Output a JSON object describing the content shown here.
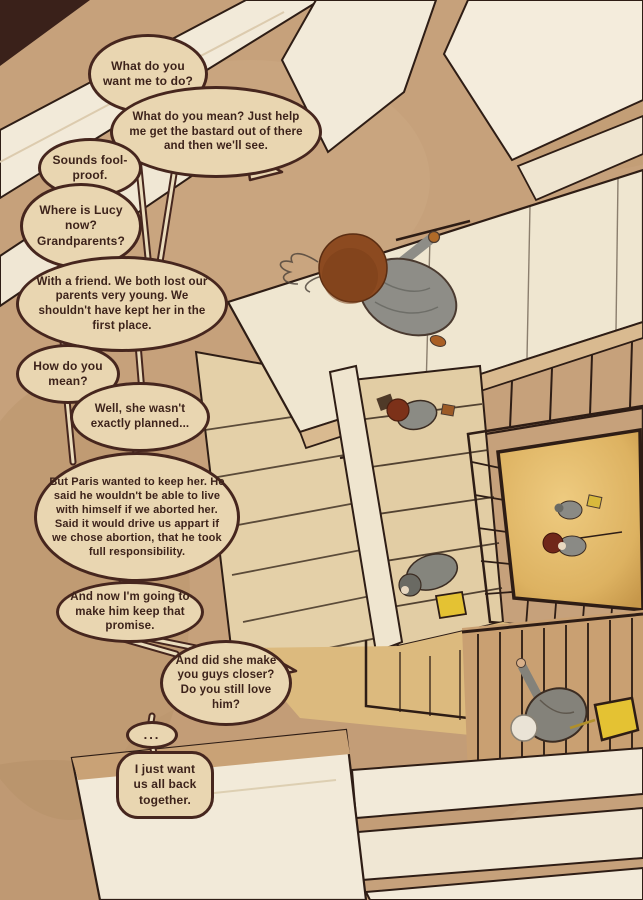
{
  "palette": {
    "paper_tan": "#c6a17b",
    "bubble_fill": "#e9d6b1",
    "bubble_outline": "#46261e",
    "text_ink": "#3d231b",
    "panel_cream": "#f2ead9",
    "floor_gold": "#e2b763",
    "bag_yellow": "#e4c233",
    "hair_brown": "#8c4a20",
    "clothes_grey": "#8e8d87"
  },
  "bubbles": [
    {
      "id": 1,
      "text": "What do you want me to do?"
    },
    {
      "id": 2,
      "text": "What do you mean? Just help me get the bastard out of there and then we'll see."
    },
    {
      "id": 3,
      "text": "Sounds fool-proof."
    },
    {
      "id": 4,
      "text": "Where is Lucy now? Grandparents?"
    },
    {
      "id": 5,
      "text": "With a friend. We both lost our parents very young. We shouldn't have kept her in the first place."
    },
    {
      "id": 6,
      "text": "How do you mean?"
    },
    {
      "id": 7,
      "text": "Well, she wasn't exactly planned..."
    },
    {
      "id": 8,
      "text": "But Paris wanted to keep her. He said he wouldn't be able to live with himself if we aborted her. Said it would drive us appart if we chose abortion, that he took full responsibility."
    },
    {
      "id": 9,
      "text": "And now I'm going to make him keep that promise."
    },
    {
      "id": 10,
      "text": "And did she make you guys closer? Do you still love him?"
    },
    {
      "id": 11,
      "text": "..."
    },
    {
      "id": 12,
      "text": "I just want us all back together."
    }
  ]
}
